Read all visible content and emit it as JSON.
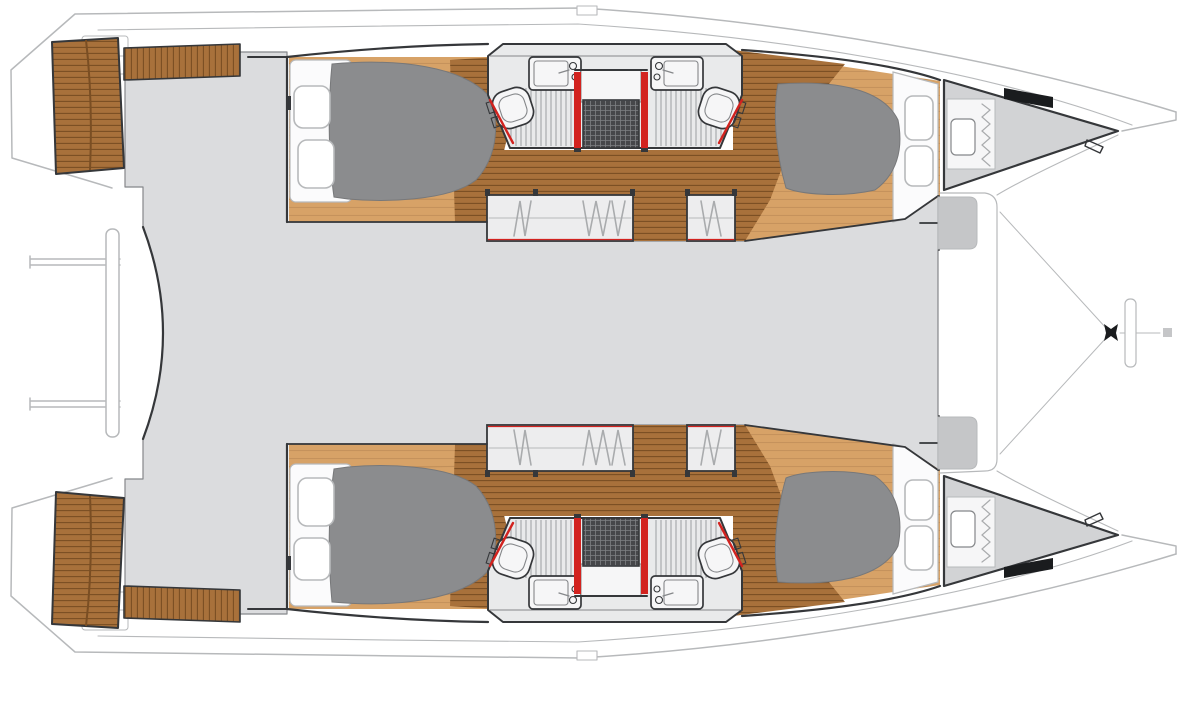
{
  "title": "Catamaran accommodation floor plan - top-down view with 4 double cabins, 4 bathrooms, saloon, cockpit and trampoline",
  "colors": {
    "white": "#ffffff",
    "outline_dark": "#35373a",
    "outline_mid": "#85878a",
    "outline_light": "#b7b9bb",
    "deck_gray": "#dbdcde",
    "step_gray": "#c5c6c8",
    "forepeak_gray": "#d2d3d5",
    "bed_gray": "#8b8c8e",
    "bed_edge": "#77787a",
    "teak_dark": "#a8713b",
    "teak_line": "#7a4e23",
    "teak_light": "#d7a267",
    "teak_light_line": "#c2905a",
    "bath_floor": "#e9eaeb",
    "bath_stripe": "#a9abad",
    "fixture_white": "#f6f6f7",
    "shower_dark": "#46474a",
    "shower_grid": "#7e8083",
    "door_red": "#d2231f",
    "hatch_white": "#fbfbfc",
    "black_fitting": "#1a1c1e"
  },
  "plan": {
    "view": "top-down",
    "vessel_type": "sailing catamaran",
    "bow_direction": "right",
    "hulls": [
      {
        "id": "port",
        "position": "top",
        "spaces": [
          "swim-platform",
          "aft-double-cabin",
          "aft-bathroom",
          "central-shower",
          "forward-bathroom",
          "forward-double-cabin",
          "forepeak-locker-berth"
        ]
      },
      {
        "id": "starboard",
        "position": "bottom",
        "spaces": [
          "swim-platform",
          "aft-double-cabin",
          "aft-bathroom",
          "central-shower",
          "forward-bathroom",
          "forward-double-cabin",
          "forepeak-locker-berth"
        ]
      }
    ],
    "center_spaces": [
      "aft-davits",
      "cockpit",
      "saloon",
      "foredeck-steps",
      "foredeck",
      "trampoline",
      "bowsprit-fitting"
    ],
    "fixture_counts": {
      "double_beds": 4,
      "toilets": 4,
      "sinks": 4,
      "showers": 2,
      "wardrobes": 4,
      "deck_hatches": 8,
      "swim_platforms": 2,
      "red_door_posts": 4
    }
  }
}
